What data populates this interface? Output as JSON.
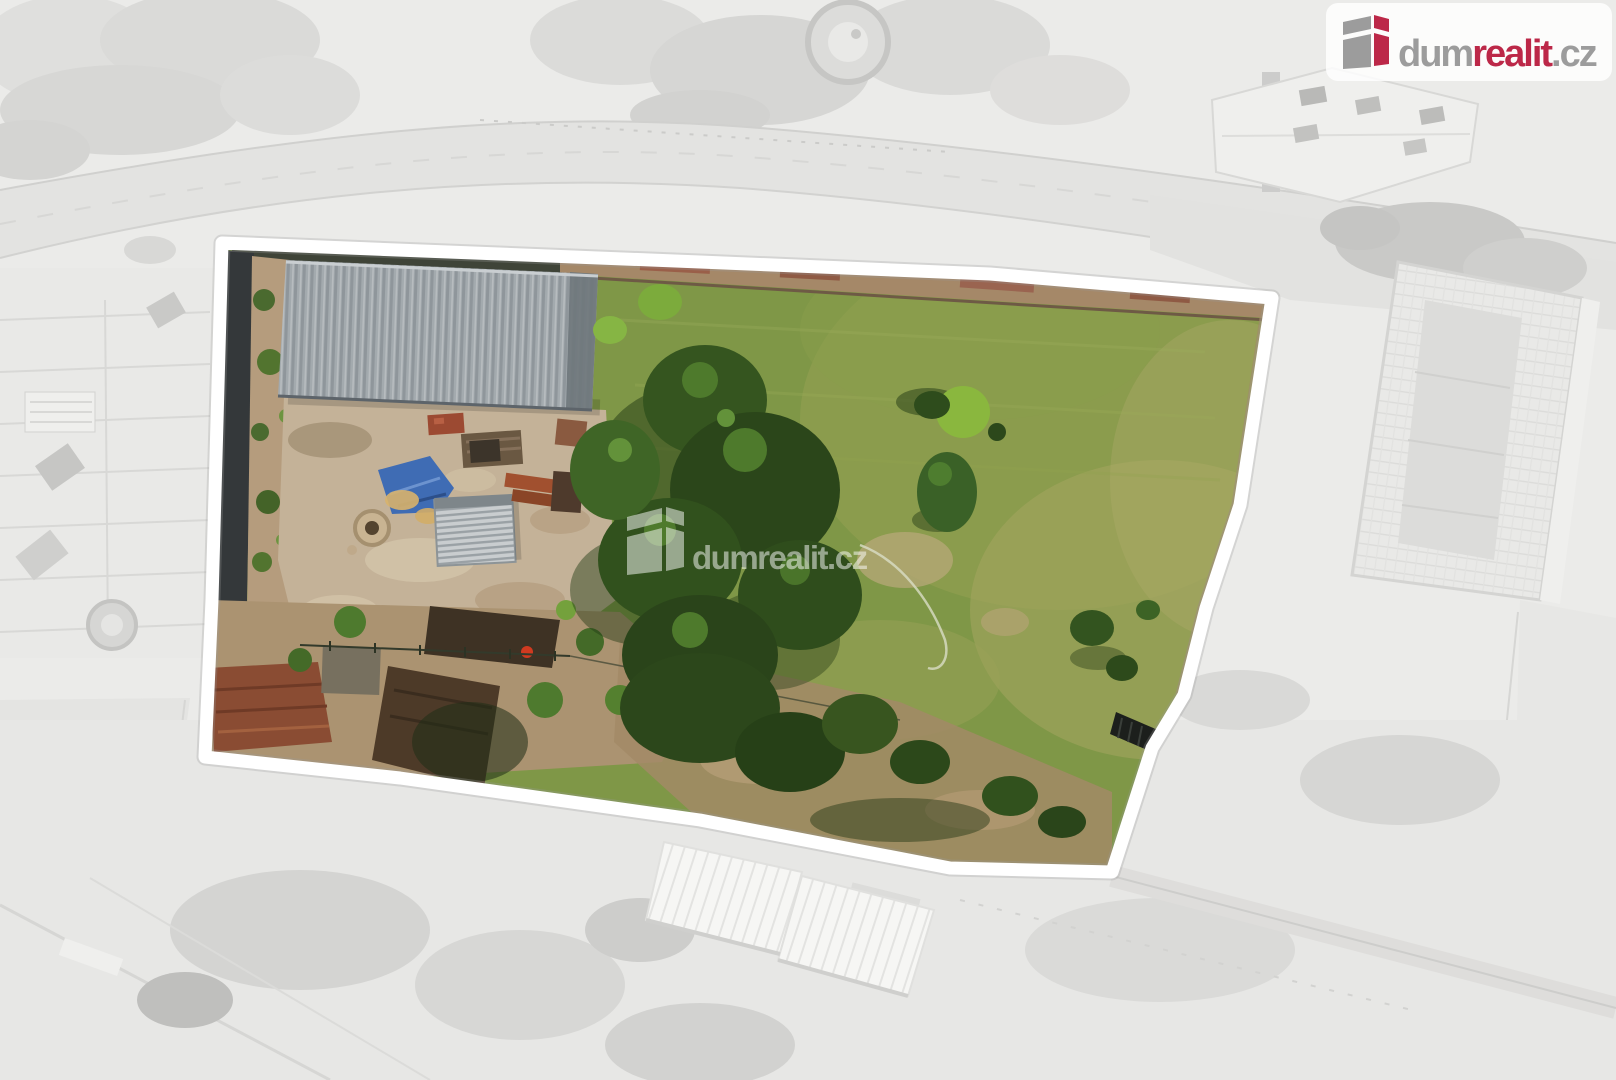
{
  "brand": {
    "name": "dumrealit.cz",
    "text_dum": "dum",
    "text_realit": "realit",
    "text_cz": ".cz",
    "gray": "#9c9c9c",
    "red": "#bc2848",
    "badge_fill": "#ffffff",
    "badge_opacity": "0.82"
  },
  "watermark": {
    "text_dum": "dum",
    "text_realit": "realit",
    "text_cz": ".cz",
    "color": "#ffffff",
    "opacity": "0.5"
  },
  "parcel": {
    "outline_color": "#ffffff"
  },
  "scene": {
    "background_fade": "#ebebe9",
    "grass": "#7f9747",
    "dirt_yard": "#c4b298",
    "tarp_blue": "#3f6cb4",
    "roof_dark_edge": "#6f777c"
  }
}
